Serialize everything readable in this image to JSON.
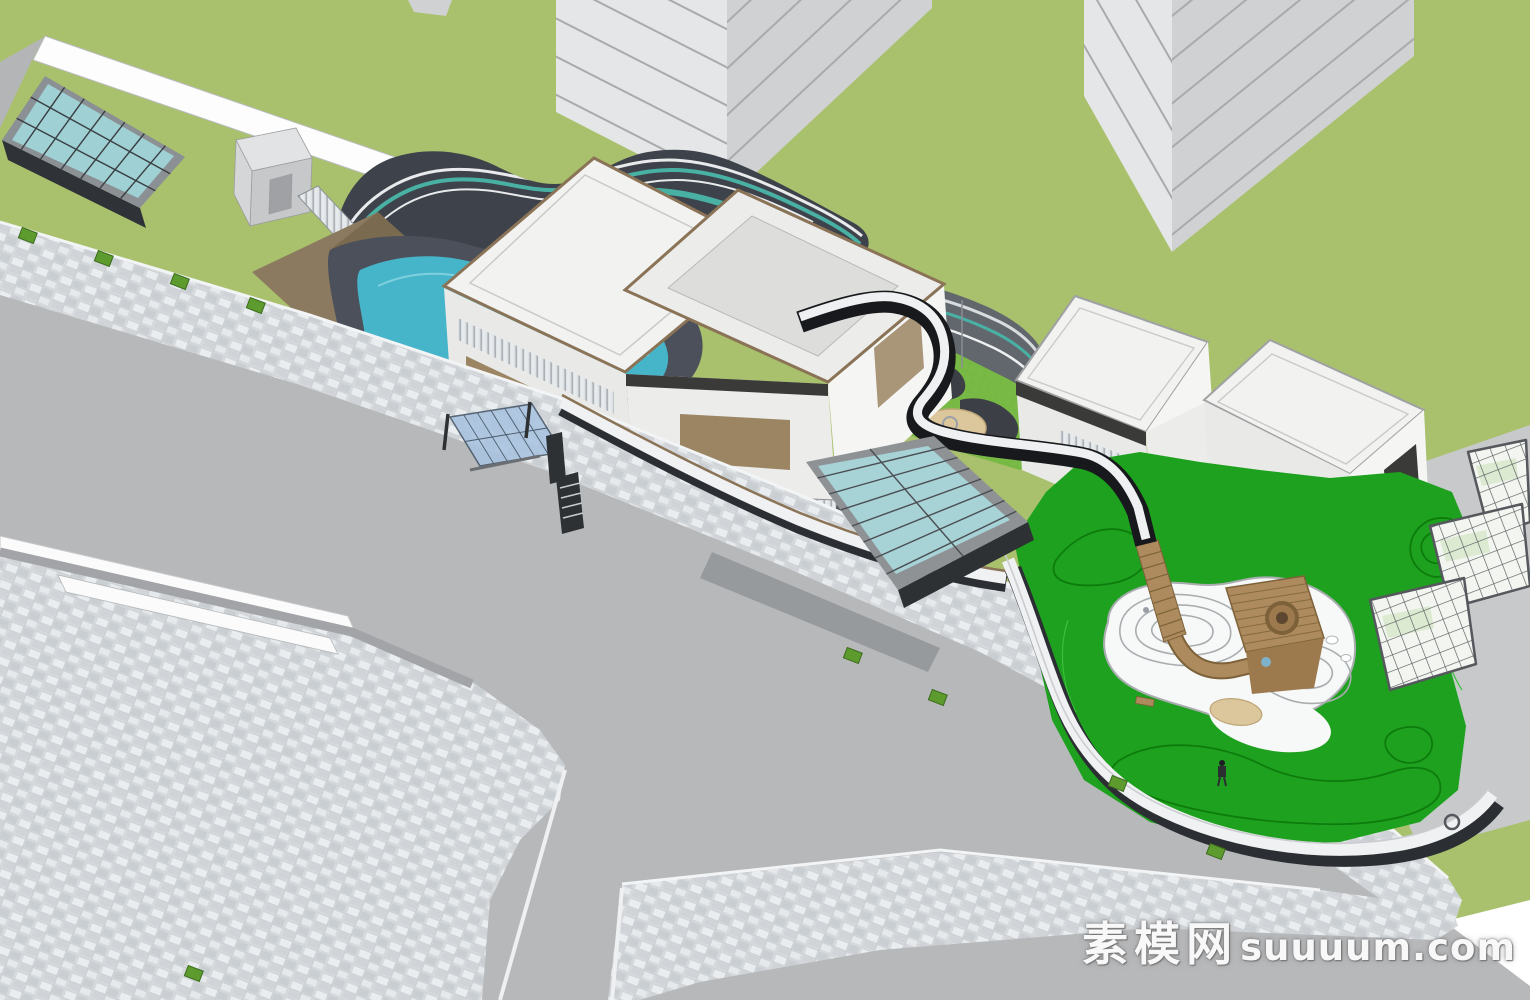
{
  "watermark": {
    "cjk": "素模网",
    "latin": "suuuum.com"
  },
  "colors": {
    "background": "#ffffff",
    "grass": "#a9c16c",
    "road": "#b7b8ba",
    "sidewalk_base": "#d6d9dc",
    "tile_light": "#e9edf0",
    "tile_mid": "#c9ced3",
    "plaza_wall": "#a2a4a7",
    "curb_white": "#fbfbfb",
    "tower_light": "#e5e6e7",
    "tower_shade": "#d0d1d2",
    "tower_line": "#a8aaac",
    "wall_white": "#fdfdfd",
    "wedge_gray": "#b3b5b7",
    "skylight_glass": "#9ed0d4",
    "skylight_frame": "#8b9094",
    "skylight_base": "#2f3236",
    "kiosk_top": "#e2e3e4",
    "kiosk_front": "#c6c8ca",
    "kiosk_side": "#d5d6d8",
    "canopy_dark": "#3e434b",
    "stripe_white": "#e8eaec",
    "stripe_teal": "#49b0a4",
    "terrace_gray": "#62676e",
    "bronze": "#8b7a5f",
    "bronze_shade": "#6e5c44",
    "bronze_dark": "#4e4234",
    "louver_base": "#dfe2e5",
    "louver_light": "#e8ebee",
    "louver_dark": "#aab0b5",
    "pool_deck": "#4b505a",
    "pool_teal": "#47b5c9",
    "pool_edge": "#7ed0de",
    "island_green": "#9dc25f",
    "island_line": "#74983f",
    "play_lawn": "#78ba45",
    "play_path": "#3c4046",
    "sand": "#dcc69c",
    "sand_edge": "#bfa67a",
    "roof_white": "#f2f2f0",
    "roof_trim": "#8a7356",
    "courtyard_floor": "#dddddb",
    "facade_white": "#e9eae8",
    "facade_light": "#f5f5f3",
    "facade_mid": "#ececea",
    "window_bronze": "#9b8563",
    "dark_reveal": "#3a3a38",
    "walkway_black": "#17191c",
    "walkway_top": "#eef0f1",
    "wood": "#ad8b5f",
    "wood_dark": "#7d6239",
    "wood_mid": "#9c7a4e",
    "lawn_green": "#1ea11e",
    "lawn_contour": "#0d7c0d",
    "lawn_light": "#3cbf3c",
    "play_white": "#f7f8f8",
    "play_line": "#a9adb0",
    "fence_white": "#f0f1f2",
    "fence_base": "#2b2e33",
    "fence_rail": "#8a7356",
    "gh_glass": "#f3f6f0",
    "gh_tint": "#dcead2",
    "gh_frame": "#55585c",
    "path_gray": "#c7c9cb",
    "glass_center": "#a7d2d6",
    "glass_frame": "#8e9295",
    "glass_mullion": "#4a4e52",
    "glass_base": "#2e3134",
    "shelter_glass": "#aac4e0",
    "shelter_dark": "#2e3134",
    "planter_green": "#5d9b2e",
    "planter_edge": "#3a6b1d",
    "step_gray": "#55585c",
    "watermark_color": "#ffffff"
  }
}
